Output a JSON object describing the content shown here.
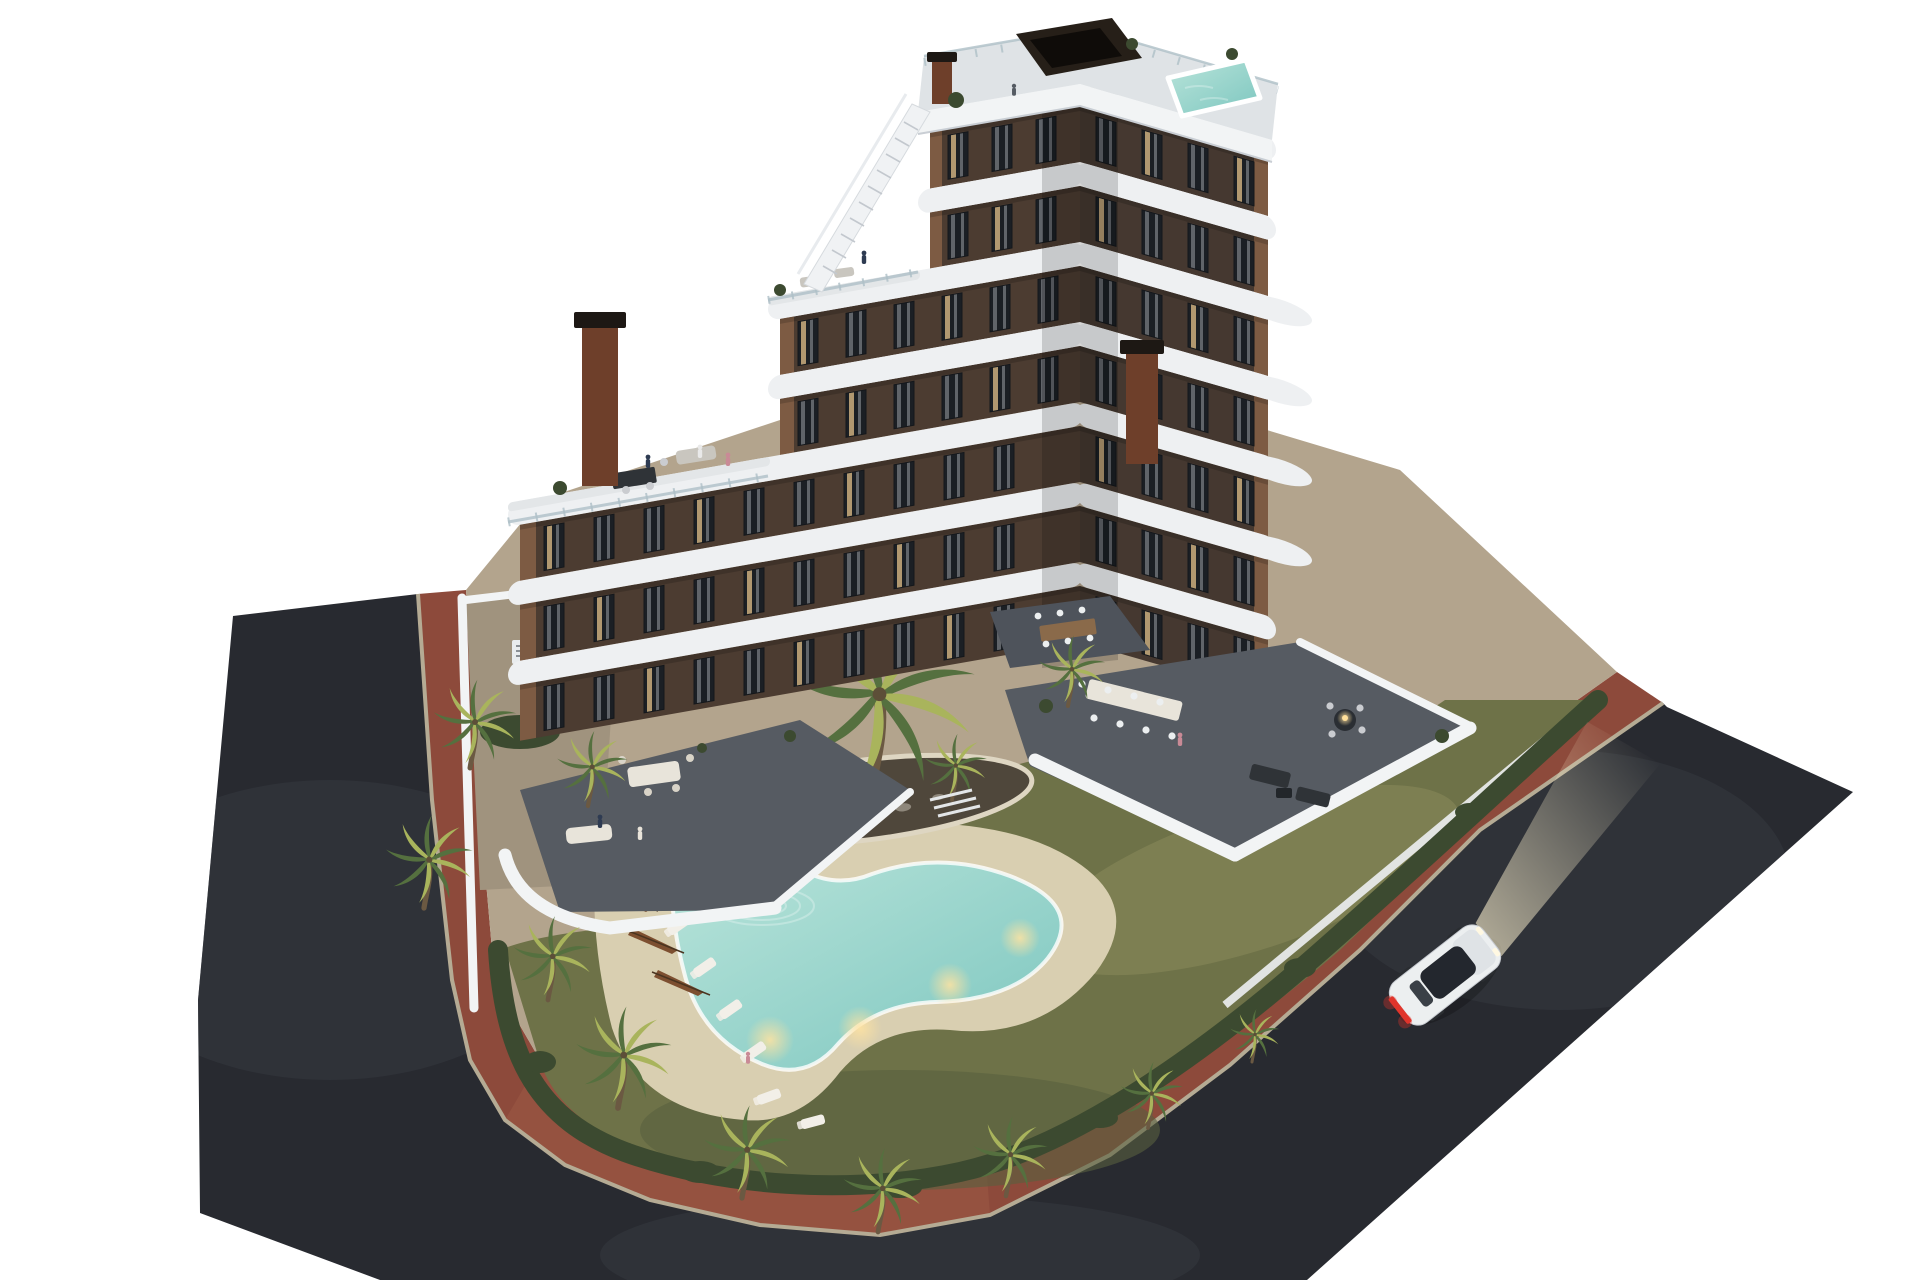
{
  "scene": {
    "kind": "aerial 3d architectural render of residential complex at dusk",
    "background_color": "#ffffff"
  },
  "palette": {
    "background": "#ffffff",
    "asphalt": "#282a30",
    "asphalt_light": "#35383f",
    "sidewalk_brick": "#8d4a3b",
    "sidewalk_brick_light": "#9d5a46",
    "curb": "#b5ab94",
    "concrete": "#b3a48d",
    "lawn": "#6e7248",
    "lawn_light": "#8b8a5b",
    "lawn_dark": "#59613f",
    "hedge": "#3c4a30",
    "palm_light": "#a9b45c",
    "palm_dark": "#55703f",
    "trunk": "#6b5942",
    "paving_dark": "#565b62",
    "wall_white": "#f2f4f5",
    "slab_white": "#eef0f2",
    "facade_lit": "#7d5b43",
    "facade_shaded": "#4c3c31",
    "facade_dark": "#453830",
    "window_glass": "#1b1f24",
    "window_warm": "#e4c289",
    "curtain": "#c8cdd3",
    "corten": "#6e3f2a",
    "glass_rail": "#aebfc7",
    "pool_water": "#7cc6bf",
    "pool_water_light": "#b9e4da",
    "pool_deck": "#d9cfb1",
    "pool_glow": "#ffe3a1",
    "umbrella": "#7d4f30",
    "lounger": "#f2efe8",
    "furniture_dark": "#2f3337",
    "furniture_white": "#e8e4da",
    "wood": "#8a6a4a",
    "rock": "#8e877b",
    "car_body": "#eceff0",
    "car_glass": "#23272e",
    "taillight": "#e0352b",
    "headlight_glow": "#fff3d0"
  },
  "site": {
    "building": {
      "storeys": 7,
      "white_balcony_bands": 6,
      "facade": "dark brown with curved white slabs",
      "chimneys": 2,
      "rooftop": {
        "pergola": true,
        "plunge_pool": true,
        "access_stair": true,
        "glass_railing": true
      }
    },
    "garden": {
      "pool_shape": "curved freeform with underwater lights",
      "pool_lights": 4,
      "sun_loungers": 7,
      "closed_umbrellas": 3,
      "palm_trees": 14,
      "island_planter": 1,
      "perimeter": "white walls with hedges and red brick sidewalk"
    },
    "ground_floor": {
      "private_terraces": 3,
      "communal_dining_table": true
    },
    "street": {
      "surface": "asphalt ring road",
      "sidewalk": "red brick with pale curb"
    },
    "vehicles": [
      {
        "type": "car",
        "color": "white",
        "lights": "on",
        "location": "right street"
      }
    ],
    "people_visible": 10
  }
}
